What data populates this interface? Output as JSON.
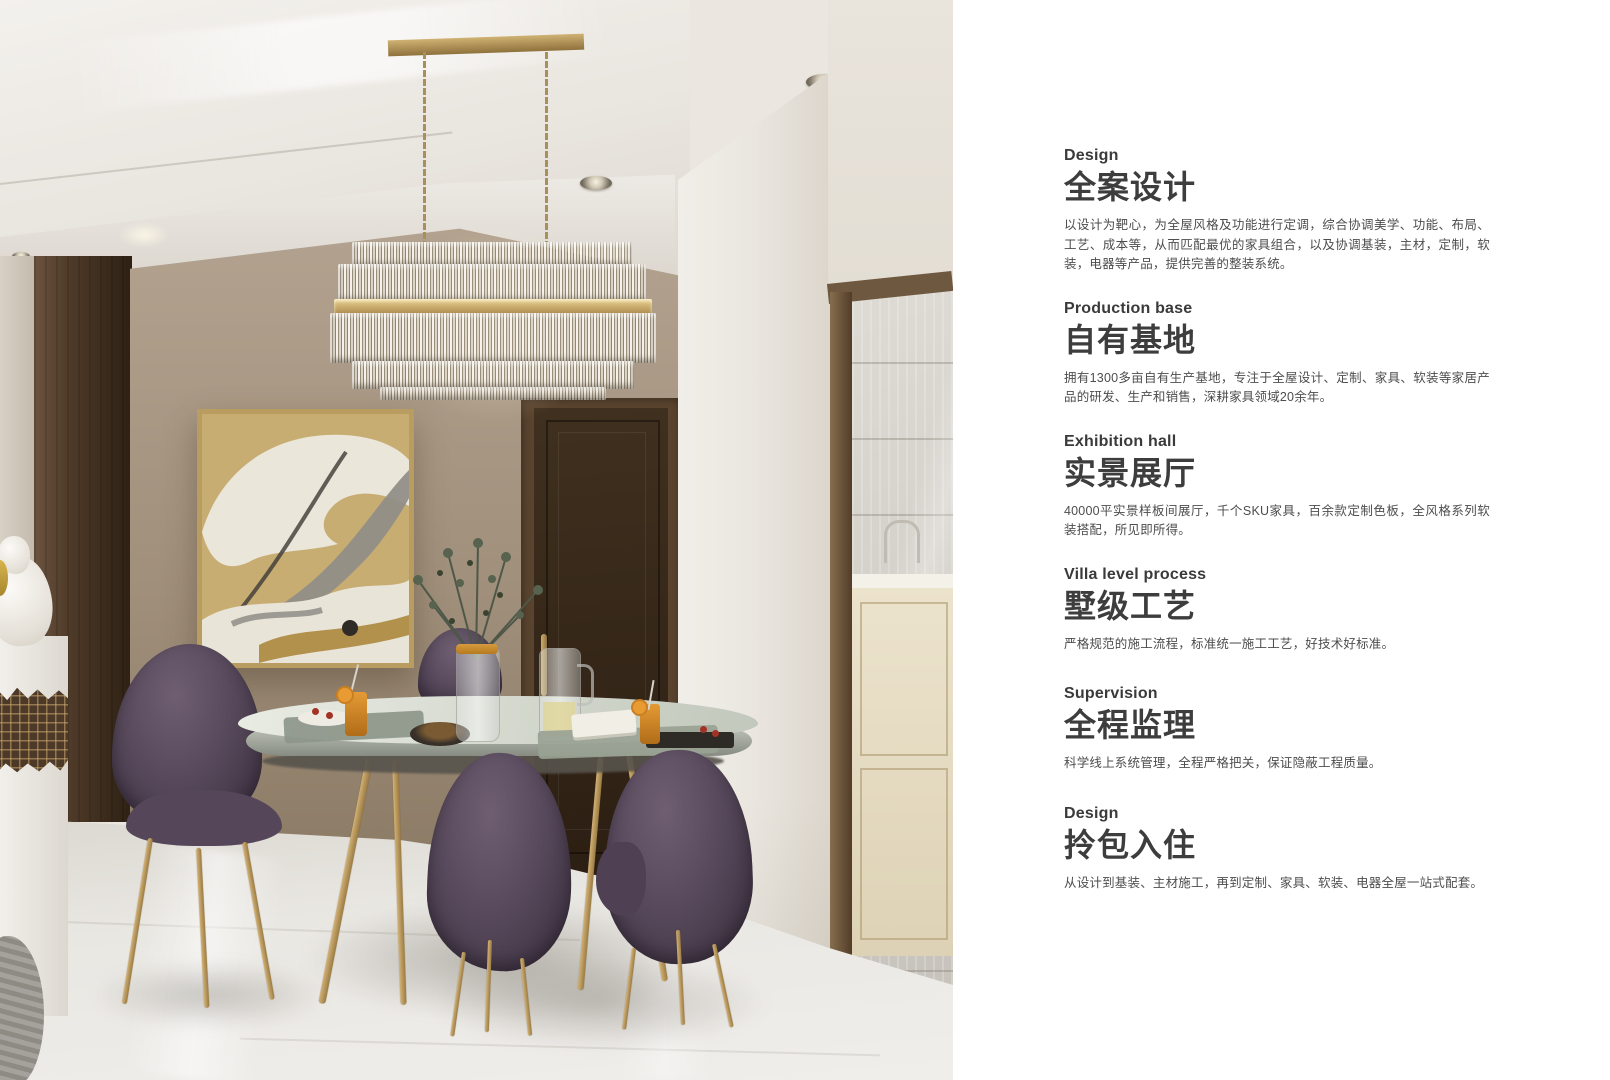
{
  "sections": [
    {
      "label": "Design",
      "title": "全案设计",
      "body": "以设计为靶心，为全屋风格及功能进行定调，综合协调美学、功能、布局、工艺、成本等，从而匹配最优的家具组合，以及协调基装，主材，定制，软装，电器等产品，提供完善的整装系统。"
    },
    {
      "label": "Production base",
      "title": "自有基地",
      "body": "拥有1300多亩自有生产基地，专注于全屋设计、定制、家具、软装等家居产品的研发、生产和销售，深耕家具领域20余年。"
    },
    {
      "label": "Exhibition hall",
      "title": "实景展厅",
      "body": "40000平实景样板间展厅，千个SKU家具，百余款定制色板，全风格系列软装搭配，所见即所得。"
    },
    {
      "label": "Villa level process",
      "title": "墅级工艺",
      "body": "严格规范的施工流程，标准统一施工工艺，好技术好标准。"
    },
    {
      "label": "Supervision",
      "title": "全程监理",
      "body": "科学线上系统管理，全程严格把关，保证隐蔽工程质量。"
    },
    {
      "label": "Design",
      "title": "拎包入住",
      "body": "从设计到基装、主材施工，再到定制、家具、软装、电器全屋一站式配套。"
    }
  ],
  "palette": {
    "panel_background": "#ffffff",
    "heading_text": "#3d3d3d",
    "body_text": "#4d4d4d",
    "accent_gold": "#b3924f",
    "chair_purple": "#55465a",
    "wood_brown": "#3c2b1c",
    "wall_taupe": "#a59481",
    "floor": "#e7e5e0"
  }
}
